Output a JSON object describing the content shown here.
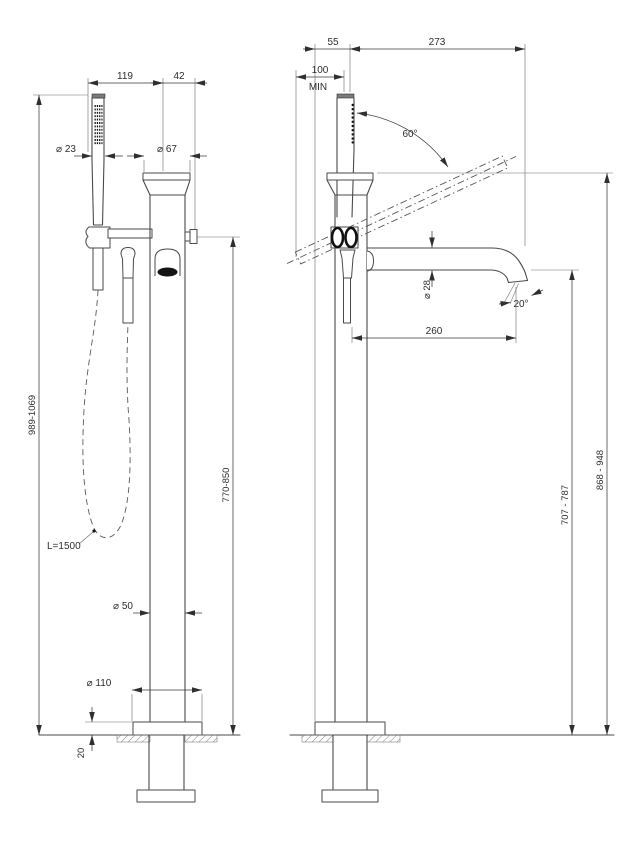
{
  "front_view": {
    "dim_shower_to_column": "119",
    "dim_column_to_knob": "42",
    "dim_handshower_diameter": "⌀ 23",
    "dim_column_top_diameter": "⌀ 67",
    "dim_total_height": "989-1069",
    "dim_outlet_height": "770-850",
    "hose_length_label": "L=1500",
    "dim_column_diameter": "⌀ 50",
    "dim_base_diameter": "⌀ 110",
    "dim_base_plate_height": "20"
  },
  "side_view": {
    "dim_base_edge_to_axis": "55",
    "dim_axis_to_spout_tip": "273",
    "dim_wall_clearance": "100",
    "dim_wall_clearance_qualifier": "MIN",
    "dim_handshower_rotation_angle": "60°",
    "dim_spout_diameter": "⌀ 28",
    "dim_stream_angle": "20°",
    "dim_spout_reach": "260",
    "dim_spout_bottom_height": "707 - 787",
    "dim_column_top_height": "868 - 948"
  },
  "colors": {
    "background": "#ffffff",
    "line": "#4a4a4a",
    "dimension_line": "#3a3a3a",
    "text": "#2e2e2e",
    "dark_fill": "#141414"
  }
}
